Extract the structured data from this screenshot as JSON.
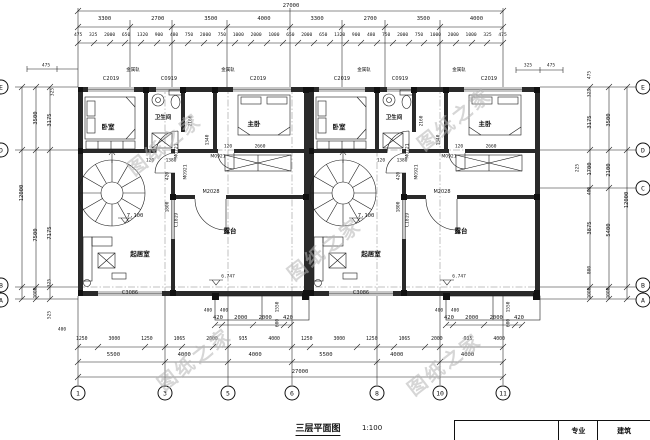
{
  "title": {
    "name": "三层平面图",
    "scale": "1:100"
  },
  "title_block": {
    "label": "专业",
    "value": "建筑"
  },
  "watermark": {
    "text": "图纸之家"
  },
  "grid": {
    "bottom": [
      "1",
      "3",
      "5",
      "6",
      "8",
      "10",
      "11"
    ],
    "right": [
      "E",
      "D",
      "C",
      "B",
      "A"
    ],
    "left": [
      "E",
      "D",
      "B",
      "A"
    ]
  },
  "dims": {
    "top_total": "27000",
    "top_major": [
      "3300",
      "2700",
      "3500",
      "4000",
      "3300",
      "2700",
      "3500",
      "4000"
    ],
    "top_minor": [
      "475",
      "325",
      "2000",
      "650",
      "1320",
      "900",
      "480",
      "750",
      "2000",
      "750",
      "1000",
      "2000",
      "1000",
      "650",
      "2000",
      "650",
      "1320",
      "900",
      "480",
      "750",
      "2000",
      "750",
      "1000",
      "2000",
      "1000",
      "325",
      "475"
    ],
    "bottom_total": "27000",
    "bottom_major": [
      "5500",
      "4000",
      "4000",
      "5500",
      "4000",
      "4000"
    ],
    "bottom_minor": [
      "1250",
      "3000",
      "1250",
      "1065",
      "2000",
      "935",
      "4000",
      "1250",
      "3000",
      "1250",
      "1065",
      "2000",
      "935",
      "4000"
    ],
    "bay": [
      "420",
      "2000",
      "2000",
      "420"
    ],
    "left": [
      "475",
      "325",
      "3500",
      "3175",
      "12000",
      "7500",
      "7175",
      "325",
      "1000",
      "525",
      "400"
    ],
    "right": [
      "475",
      "325",
      "3500",
      "3175",
      "2100",
      "1700",
      "400",
      "5400",
      "3875",
      "800",
      "1000",
      "1000",
      "12000",
      "225"
    ],
    "right_top": [
      "325",
      "475"
    ]
  },
  "plan": {
    "bedroom": "卧室",
    "master": "主卧",
    "bath": "卫生间",
    "living": "起居室",
    "terrace": "露台",
    "rail_note": "金属轨",
    "elev_living": "7.100",
    "elev_terrace": "6.747",
    "win_c2019": "C2019",
    "win_c0919": "C0919",
    "win_c3086": "C3086",
    "win_c1819": "C1819",
    "door_m2028": "M2028",
    "door_m0921": "M0921",
    "door_m0721": "M0721",
    "d120": "120",
    "d1380": "1380",
    "d2660": "2660",
    "d2160": "2160",
    "d1340": "1340",
    "d420": "420",
    "d1800": "1800",
    "d400": "400",
    "d1550": "1550",
    "d600": "600"
  }
}
